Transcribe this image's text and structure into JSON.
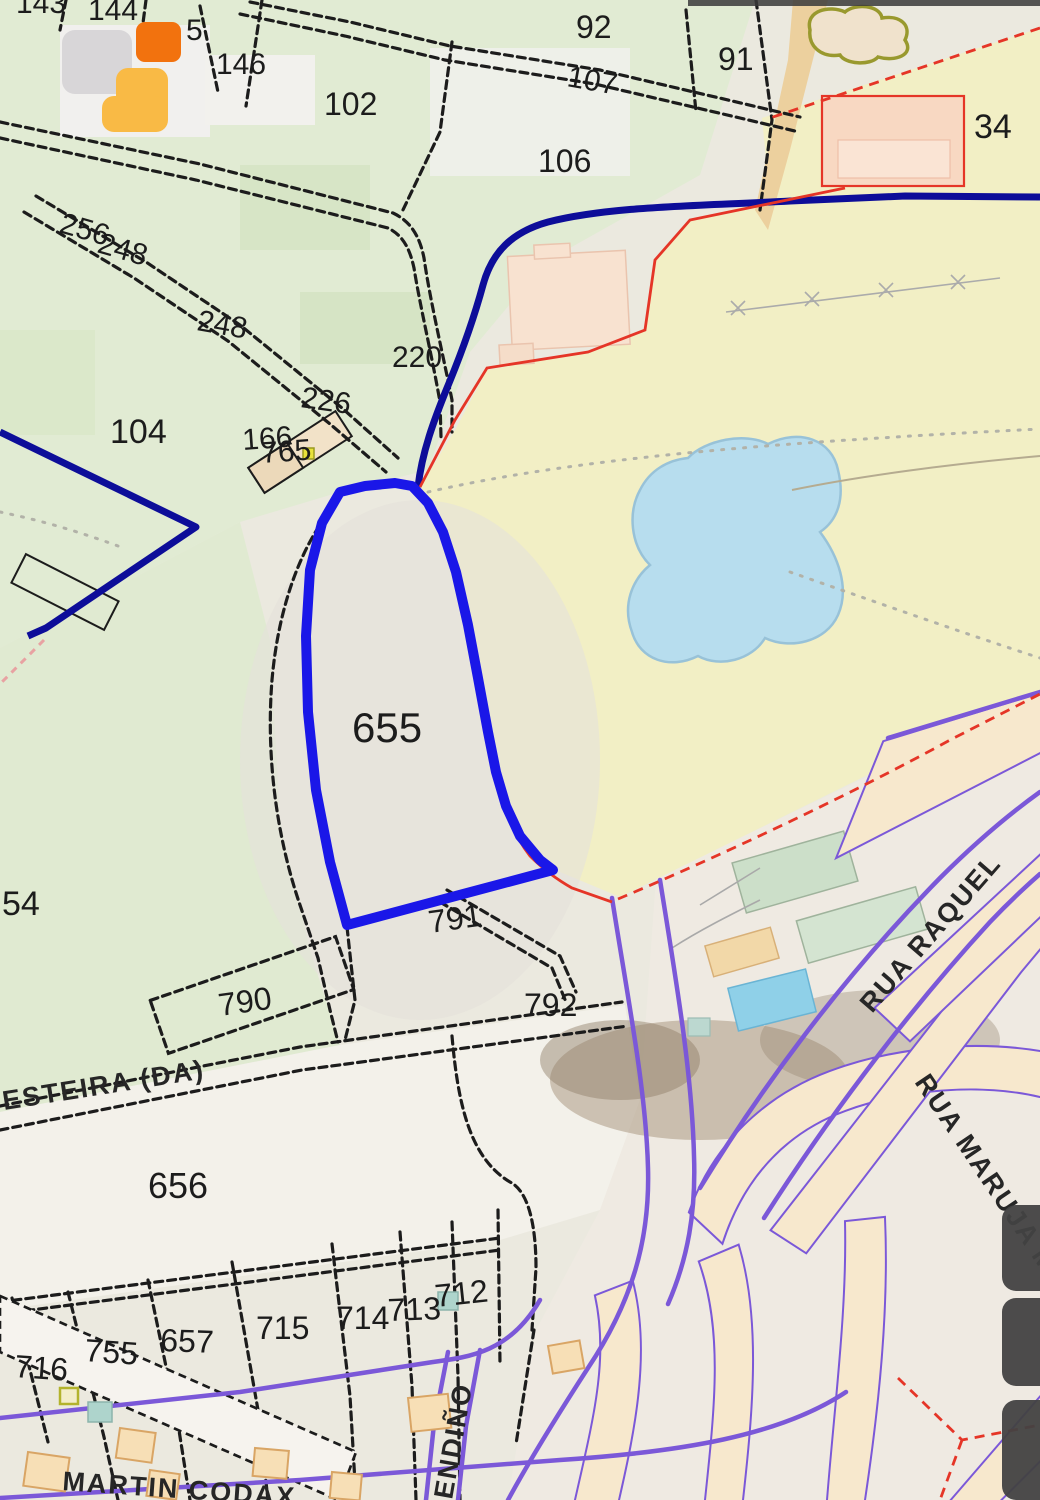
{
  "app": {
    "logo": {
      "squares": [
        "gray-square",
        "orange-square",
        "amber-square"
      ],
      "colors": {
        "gray": "#d8d6d8",
        "orange": "#f2720e",
        "amber": "#f9ba45"
      }
    },
    "side_buttons": [
      "panel-button-top",
      "panel-button-middle",
      "panel-button-bottom"
    ]
  },
  "map": {
    "type": "cadastral-parcel-map",
    "highlighted_parcel": "655",
    "colors": {
      "background": "#ebe9df",
      "field_green": "#e1ebd3",
      "field_yellow": "#f2efc5",
      "pond_fill": "#b7ddee",
      "pond_stroke": "#98c2d8",
      "highlight_blue": "#1a17e8",
      "boundary_navy": "#0d0d99",
      "line_red": "#e53527",
      "road_purple": "#7b58d8",
      "parcel_line": "#1c1c1c",
      "house_fill": "#f7dfb6",
      "road_tan": "#ecd09e"
    },
    "parcel_labels": [
      {
        "text": "143"
      },
      {
        "text": "144"
      },
      {
        "text": "5"
      },
      {
        "text": "146"
      },
      {
        "text": "102"
      },
      {
        "text": "92"
      },
      {
        "text": "107"
      },
      {
        "text": "91"
      },
      {
        "text": "106"
      },
      {
        "text": "34"
      },
      {
        "text": "256"
      },
      {
        "text": "248"
      },
      {
        "text": "248"
      },
      {
        "text": "220"
      },
      {
        "text": "226"
      },
      {
        "text": "104"
      },
      {
        "text": "166"
      },
      {
        "text": "765"
      },
      {
        "text": "655"
      },
      {
        "text": "791"
      },
      {
        "text": "790"
      },
      {
        "text": "792"
      },
      {
        "text": "54"
      },
      {
        "text": "656"
      },
      {
        "text": "716"
      },
      {
        "text": "755"
      },
      {
        "text": "657"
      },
      {
        "text": "715"
      },
      {
        "text": "714"
      },
      {
        "text": "713"
      },
      {
        "text": "712"
      }
    ],
    "street_labels": [
      {
        "text": "ESTEIRA (DA)"
      },
      {
        "text": "RUA RAQUEL"
      },
      {
        "text": "RUA MARUJA M"
      },
      {
        "text": "ENDIÑO"
      },
      {
        "text": "MARTIN CODAX"
      }
    ]
  }
}
